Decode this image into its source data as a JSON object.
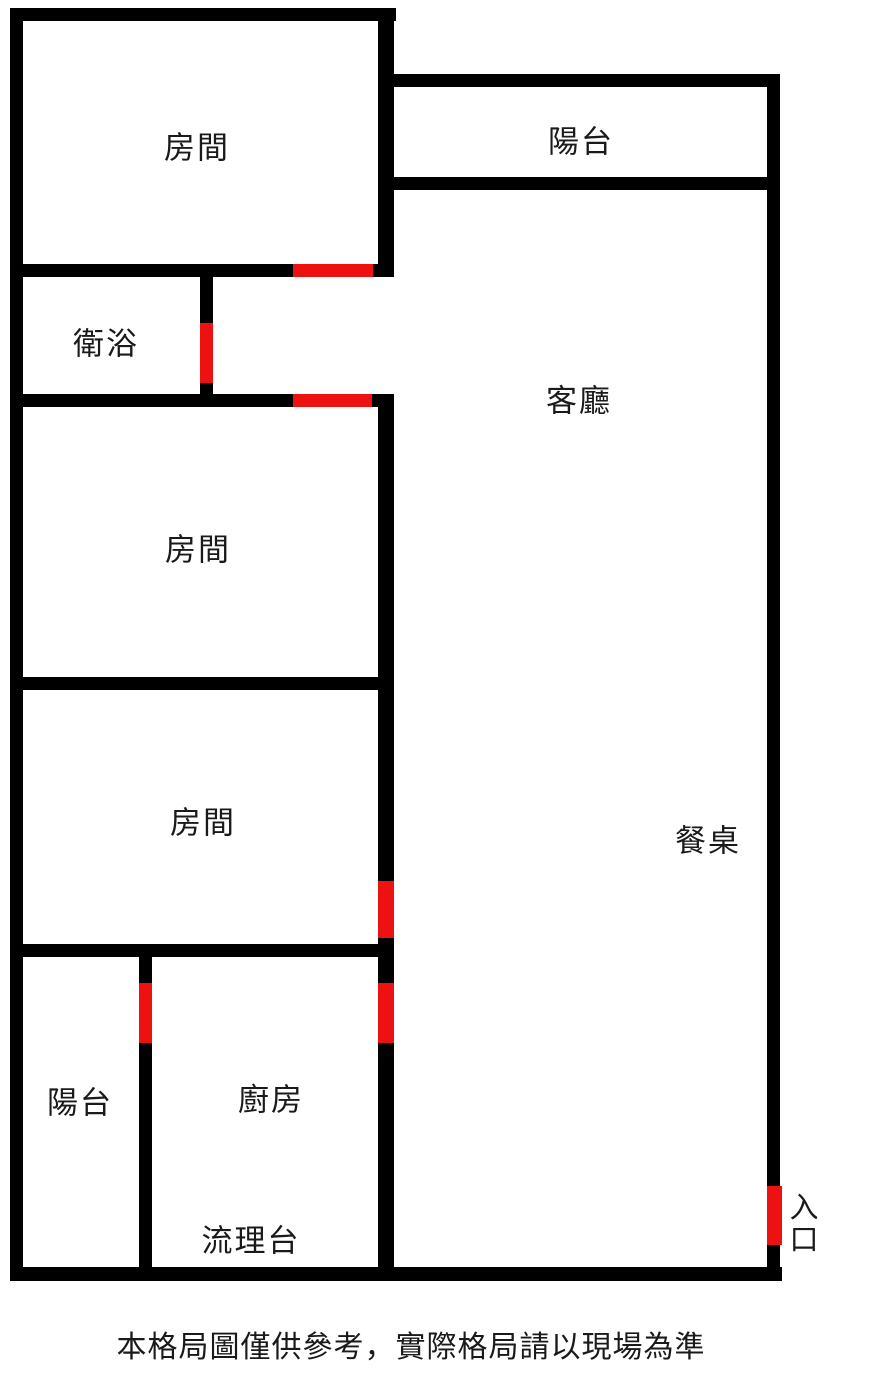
{
  "labels": {
    "bedroom_top": "房間",
    "balcony_top": "陽台",
    "bathroom": "衛浴",
    "living_room": "客廳",
    "bedroom_middle": "房間",
    "bedroom_lower": "房間",
    "dining": "餐桌",
    "balcony_bottom": "陽台",
    "kitchen": "廚房",
    "counter": "流理台",
    "entrance": "入口"
  },
  "footer": {
    "disclaimer": "本格局圖僅供參考，實際格局請以現場為準"
  },
  "colors": {
    "wall": "#000000",
    "door": "#ee1111",
    "background": "#ffffff",
    "text": "#1a1a1a"
  }
}
